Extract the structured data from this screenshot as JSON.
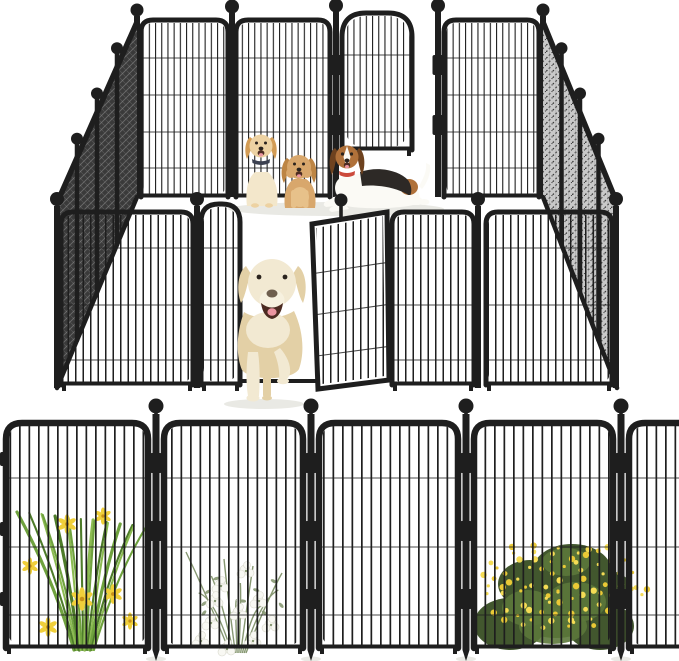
{
  "image": {
    "type": "product-photo",
    "subject": "Black metal dog playpen with four dogs inside and an open front gate, above a straight row of five fence panels decorated with flowers",
    "background": "#ffffff"
  },
  "colors": {
    "fence": "#1e1e1e",
    "mesh_left": "#3a3a3a",
    "mesh_right": "#c9c9c9",
    "hatch_left": "#8c8c8c",
    "hatch_right": "#3c3c3c",
    "shadow": "#e9e9e4",
    "golden": "#edd2a2",
    "golden_ear": "#d39c55",
    "golden_body": "#f3e7cb",
    "tan": "#d8a76c",
    "tan_ear": "#bd8544",
    "tan_light": "#e7c18a",
    "beagle_brown": "#b0713a",
    "beagle_ear": "#6e421f",
    "beagle_black": "#2d2926",
    "beagle_white": "#fbfaf5",
    "beagle_collar": "#cc4a3c",
    "lab": "#f2e9d2",
    "lab_shade": "#e3d0a6",
    "lab_light": "#f7f1df",
    "face_dark": "#2a231d",
    "nose_brown": "#6f5f4e",
    "mouth": "#4c2b21",
    "tongue": "#ec95a0",
    "collar_dark": "#3b4050",
    "grass": "#6fa23e",
    "grass_dark": "#4e7c2a",
    "grass_light": "#8cbb52",
    "lily": "#f0cf3a",
    "lily_center": "#c89018",
    "sage": "#879872",
    "white_flower": "#f8f8f3",
    "white_flower_edge": "#d8d8cc",
    "bush_dark": "#42572e",
    "bush_mid": "#5c783b",
    "bush_yellow": "#eac936",
    "bush_yellow2": "#f5dc55"
  },
  "playpen": {
    "shape": "rectangle",
    "post_finial": "ball",
    "back_wall": {
      "wide_panels": 3,
      "gate_state": "closed",
      "gate_style": "arch-top"
    },
    "left_wall": {
      "panels": 4
    },
    "right_wall": {
      "panels": 4
    },
    "front_wall": {
      "wide_panels": 3,
      "arch_panels": 1,
      "gate_state": "open",
      "gate_style": "arch-top"
    }
  },
  "dogs": [
    {
      "name": "golden-retriever-puppy",
      "pose": "sitting",
      "position": "inside-pen-left"
    },
    {
      "name": "tan-fluffy-puppy",
      "pose": "sitting",
      "position": "inside-pen-center"
    },
    {
      "name": "beagle",
      "pose": "lying",
      "position": "inside-pen-right",
      "accessory": "red-collar"
    },
    {
      "name": "cream-labrador",
      "pose": "walking",
      "position": "through-open-front-gate"
    }
  ],
  "fence_row": {
    "panel_count": 5,
    "post_count": 4,
    "post_finial": "ball",
    "panels": [
      {
        "index": 1,
        "plant": "grass-with-yellow-lilies"
      },
      {
        "index": 2,
        "plant": "white-flower-bush"
      },
      {
        "index": 3,
        "plant": "none"
      },
      {
        "index": 4,
        "plant": "yellow-flower-bush"
      },
      {
        "index": 5,
        "plant": "yellow-flower-bush-overflow"
      }
    ]
  }
}
